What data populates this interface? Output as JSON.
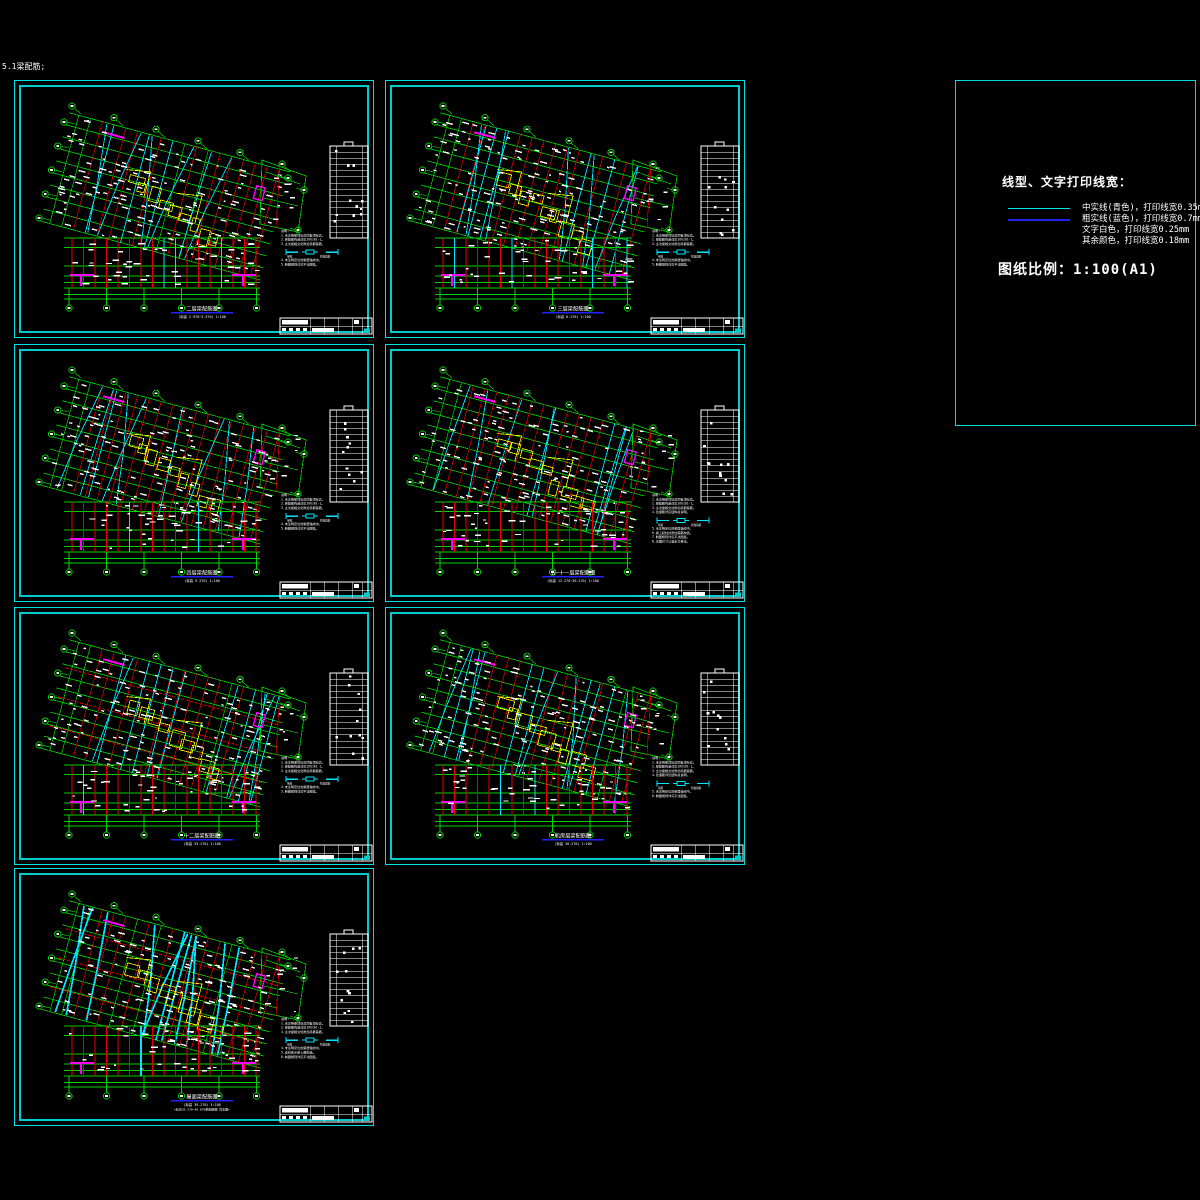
{
  "page": {
    "corner_label": "5.1梁配筋;",
    "background": "#000000"
  },
  "legend": {
    "title": "线型、文字打印线宽：",
    "items": [
      {
        "swatch_color": "#00e5ee",
        "label": "中实线(青色)，打印线宽0.35mm"
      },
      {
        "swatch_color": "#2222ee",
        "label": "粗实线(蓝色)，打印线宽0.7mm"
      },
      {
        "swatch_color": "",
        "label": "文字白色，打印线宽0.25mm"
      },
      {
        "swatch_color": "",
        "label": "其余颜色，打印线宽0.18mm"
      }
    ],
    "scale_label": "图纸比例：1:100(A1)"
  },
  "colors": {
    "frame_border": "#00e0e0",
    "green": "#00d400",
    "red": "#e80000",
    "cyan": "#00e5ff",
    "magenta": "#ff00ff",
    "yellow": "#ffff00",
    "white": "#ffffff",
    "blue_underline": "#2222ff"
  },
  "frames": [
    {
      "id": "1",
      "row": 0,
      "col": 0,
      "seed": 11,
      "title": "二层梁配筋图",
      "subtitle": "(标高 2.970~3.570)  1:100",
      "extra": "",
      "style": "normal",
      "notes": [
        "说明:",
        "1.未注明梁顶标高同板顶标高。",
        "2.梁配筋构造详见16G101-1。",
        "3.主次梁相交处附加吊筋箍筋。"
      ],
      "symbol_labels": [
        "吊筋",
        "附加箍筋"
      ],
      "notes_tail": [
        "4.未注明定位的梁居轴线中。",
        "5.制图规则详见平法图集。"
      ]
    },
    {
      "id": "2",
      "row": 0,
      "col": 1,
      "seed": 22,
      "title": "三层梁配筋图",
      "subtitle": "(标高 6.270)  1:100",
      "extra": "",
      "style": "normal",
      "notes": [
        "说明:",
        "1.未注明梁顶标高同板顶标高。",
        "2.梁配筋构造详见16G101-1。",
        "3.主次梁相交处附加吊筋箍筋。"
      ],
      "symbol_labels": [
        "吊筋",
        "附加箍筋"
      ],
      "notes_tail": [
        "4.未注明定位的梁居轴线中。",
        "5.制图规则详见平法图集。"
      ]
    },
    {
      "id": "3",
      "row": 1,
      "col": 0,
      "seed": 33,
      "title": "四层梁配筋图",
      "subtitle": "(标高 9.270)  1:100",
      "extra": "",
      "style": "cyanheavy",
      "notes": [
        "说明:",
        "1.未注明梁顶标高同板顶标高。",
        "2.梁配筋构造详见16G101-1。",
        "3.主次梁相交处附加吊筋箍筋。"
      ],
      "symbol_labels": [
        "吊筋",
        "附加箍筋"
      ],
      "notes_tail": [
        "4.未注明定位的梁居轴线中。",
        "5.制图规则详见平法图集。"
      ]
    },
    {
      "id": "4",
      "row": 1,
      "col": 1,
      "seed": 44,
      "title": "五~十一层梁配筋图",
      "subtitle": "(标高 12.270~30.270)  1:100",
      "extra": "",
      "style": "normal",
      "notes": [
        "说明:",
        "1.未注明梁顶标高同板顶标高。",
        "2.梁配筋构造详见16G101-1。",
        "3.主次梁相交处附加吊筋箍筋。",
        "4.拉通筋详见结构总说明。"
      ],
      "symbol_labels": [
        "吊筋",
        "附加箍筋"
      ],
      "notes_tail": [
        "5.未注明定位的梁居轴线中。",
        "6.梁上起柱处附加箍筋构造。",
        "7.制图规则详见平法图集。",
        "8.本图尺寸以毫米为单位。"
      ]
    },
    {
      "id": "5",
      "row": 2,
      "col": 0,
      "seed": 55,
      "title": "十二层梁配筋图",
      "subtitle": "(标高 33.270)  1:100",
      "extra": "",
      "style": "reddash",
      "notes": [
        "说明:",
        "1.未注明梁顶标高同板顶标高。",
        "2.梁配筋构造详见16G101-1。",
        "3.主次梁相交处附加吊筋箍筋。"
      ],
      "symbol_labels": [
        "吊筋",
        "附加箍筋"
      ],
      "notes_tail": [
        "4.未注明定位的梁居轴线中。",
        "5.制图规则详见平法图集。"
      ]
    },
    {
      "id": "6",
      "row": 2,
      "col": 1,
      "seed": 66,
      "title": "机房层梁配筋图",
      "subtitle": "(标高 36.270)  1:100",
      "extra": "",
      "style": "normal",
      "notes": [
        "说明:",
        "1.未注明梁顶标高同板顶标高。",
        "2.梁配筋构造详见16G101-1。",
        "3.主次梁相交处附加吊筋箍筋。",
        "4.拉通筋详见结构总说明。"
      ],
      "symbol_labels": [
        "吊筋",
        "附加箍筋"
      ],
      "notes_tail": [
        "5.未注明定位的梁居轴线中。",
        "6.制图规则详见平法图集。"
      ]
    },
    {
      "id": "7",
      "row": 3,
      "col": 0,
      "seed": 77,
      "title": "屋面梁配筋图",
      "subtitle": "(标高 39.270)  1:100",
      "extra": "<标高39.270~40.870梁配筋图 同本图>",
      "style": "thickcyan",
      "notes": [
        "说明:",
        "1.未注明梁顶标高同板顶标高。",
        "2.梁配筋构造详见16G101-1。",
        "3.主次梁相交处附加吊筋箍筋。"
      ],
      "symbol_labels": [
        "吊筋",
        "附加箍筋"
      ],
      "notes_tail": [
        "4.未注明定位的梁居轴线中。",
        "5.虚线表示梁上翻构造。",
        "6.制图规则详见平法图集。"
      ]
    }
  ],
  "layout_note": "seven A1 sheets of beam reinforcement plans plus plot-style legend"
}
